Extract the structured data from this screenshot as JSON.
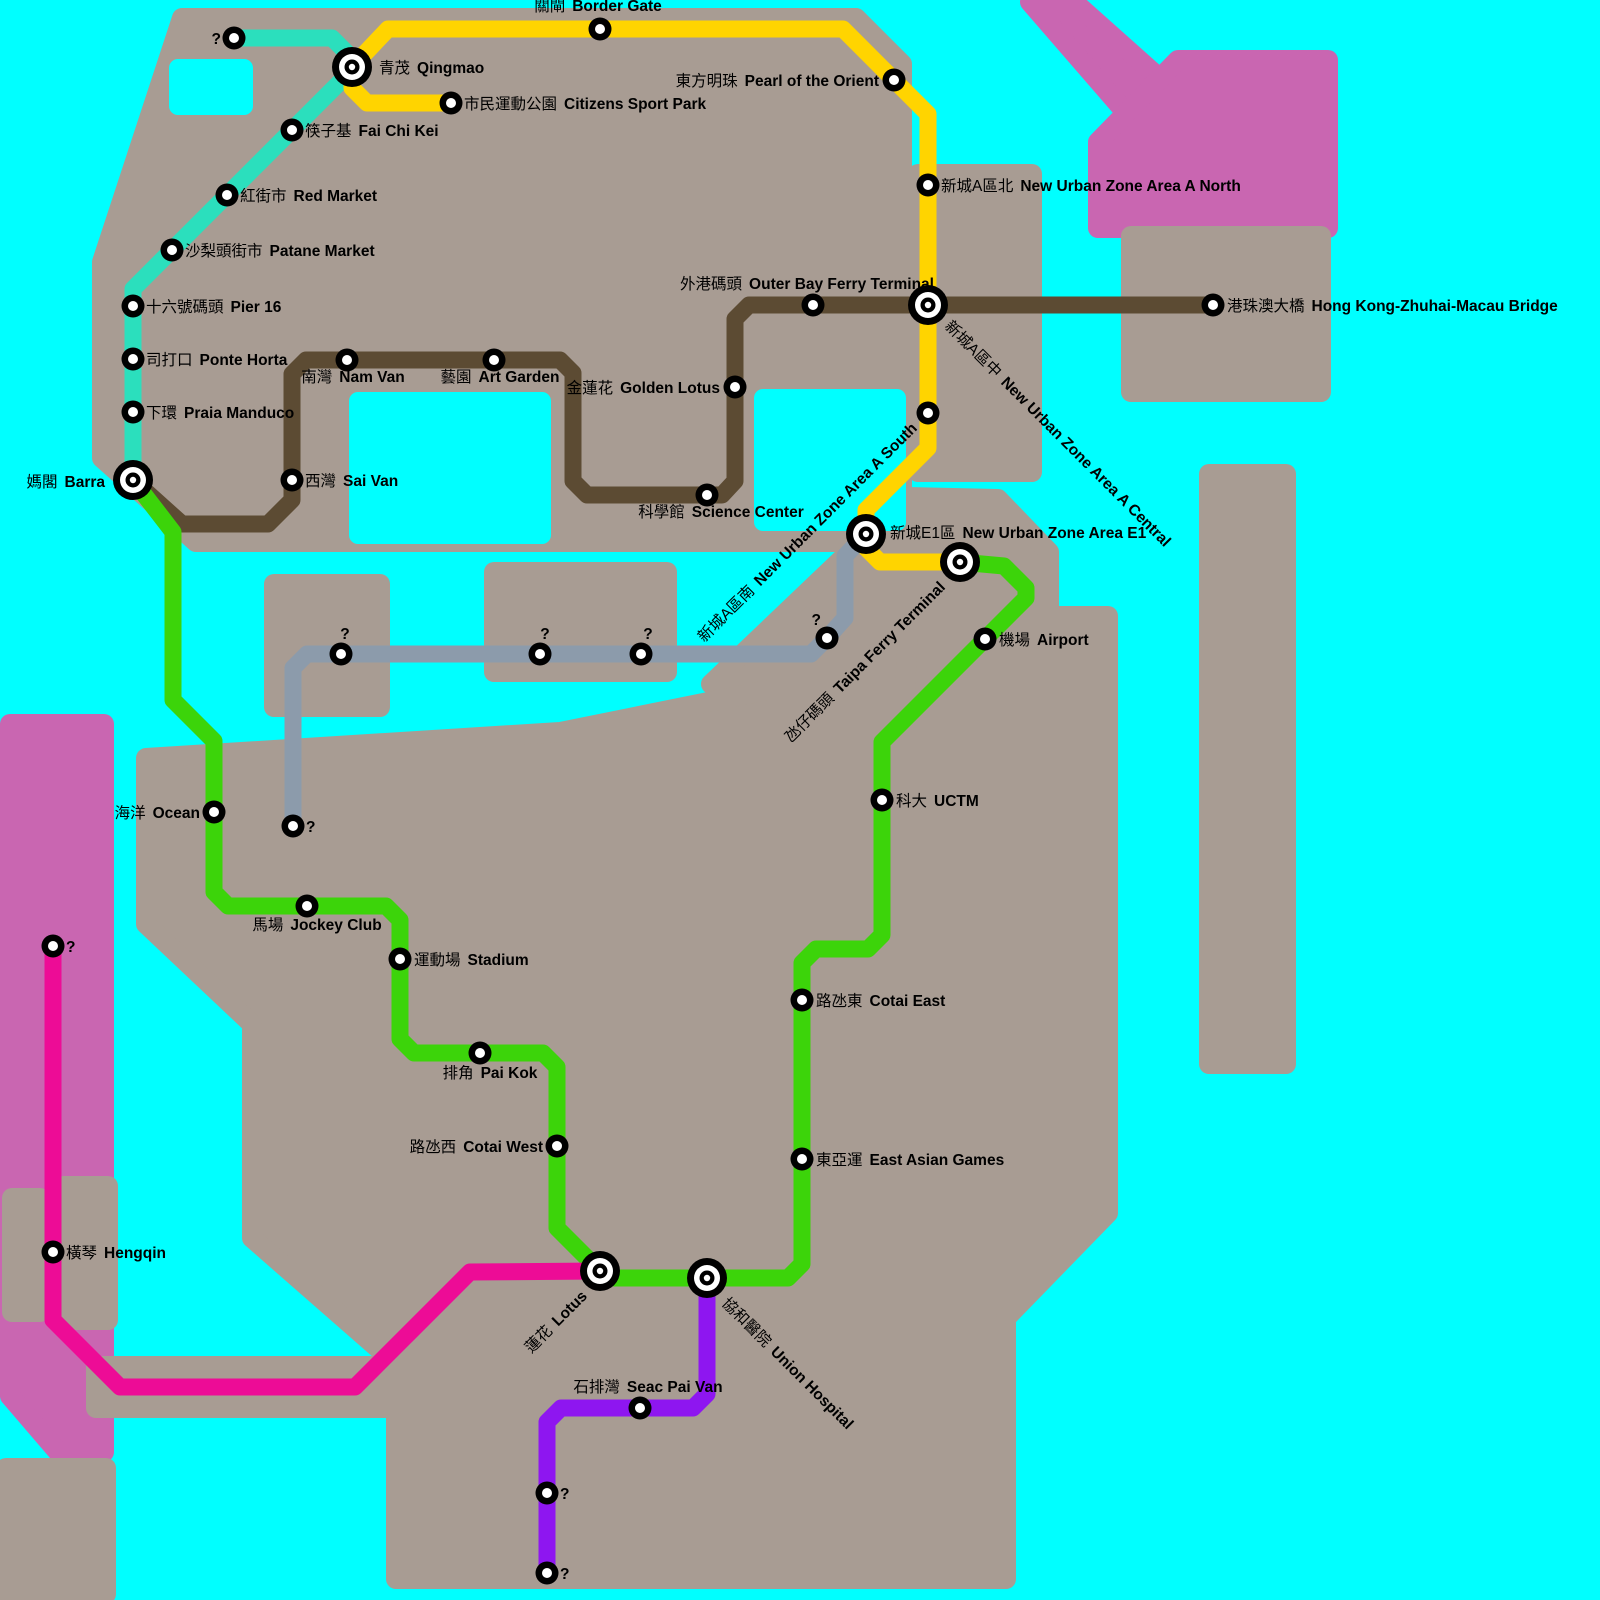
{
  "map": {
    "colors": {
      "water": "#00FFFF",
      "land": "#A89C93",
      "mainland_pink": "#C966B1",
      "station_ring": "#000000",
      "station_center": "#FFFFFF",
      "label_text": "#000000"
    },
    "lines": [
      {
        "id": "teal",
        "color": "#2BDFBD",
        "width": 17,
        "points": [
          [
            234,
            38
          ],
          [
            332,
            38
          ],
          [
            352,
            58
          ],
          [
            352,
            70
          ],
          [
            133,
            289
          ],
          [
            133,
            480
          ]
        ]
      },
      {
        "id": "yellow",
        "color": "#FFD400",
        "width": 17,
        "points": [
          [
            352,
            67
          ],
          [
            388,
            29
          ],
          [
            843,
            29
          ],
          [
            928,
            114
          ],
          [
            928,
            448
          ],
          [
            866,
            510
          ],
          [
            866,
            548
          ],
          [
            880,
            562
          ],
          [
            960,
            562
          ]
        ]
      },
      {
        "id": "yellow-branch",
        "color": "#FFD400",
        "width": 17,
        "points": [
          [
            352,
            67
          ],
          [
            352,
            88
          ],
          [
            367,
            103
          ],
          [
            451,
            103
          ]
        ]
      },
      {
        "id": "brown",
        "color": "#5C4B33",
        "width": 17,
        "points": [
          [
            133,
            480
          ],
          [
            182,
            524
          ],
          [
            268,
            524
          ],
          [
            292,
            500
          ],
          [
            292,
            374
          ],
          [
            306,
            360
          ],
          [
            560,
            360
          ],
          [
            573,
            373
          ],
          [
            573,
            481
          ],
          [
            587,
            495
          ],
          [
            722,
            495
          ],
          [
            735,
            481
          ],
          [
            735,
            319
          ],
          [
            749,
            305
          ],
          [
            1213,
            305
          ]
        ]
      },
      {
        "id": "green",
        "color": "#3CD40A",
        "width": 17,
        "points": [
          [
            133,
            480
          ],
          [
            173,
            532
          ],
          [
            173,
            700
          ],
          [
            214,
            741
          ],
          [
            214,
            892
          ],
          [
            228,
            906
          ],
          [
            386,
            906
          ],
          [
            400,
            920
          ],
          [
            400,
            1039
          ],
          [
            414,
            1053
          ],
          [
            543,
            1053
          ],
          [
            557,
            1067
          ],
          [
            557,
            1228
          ],
          [
            600,
            1271
          ],
          [
            614,
            1278
          ],
          [
            788,
            1278
          ],
          [
            802,
            1264
          ],
          [
            802,
            963
          ],
          [
            816,
            949
          ],
          [
            868,
            949
          ],
          [
            882,
            935
          ],
          [
            882,
            742
          ],
          [
            1026,
            598
          ],
          [
            1026,
            588
          ],
          [
            1004,
            566
          ],
          [
            960,
            562
          ]
        ]
      },
      {
        "id": "gray",
        "color": "#8C9BAB",
        "width": 17,
        "points": [
          [
            866,
            534
          ],
          [
            845,
            556
          ],
          [
            845,
            618
          ],
          [
            827,
            638
          ],
          [
            811,
            654
          ],
          [
            307,
            654
          ],
          [
            293,
            668
          ],
          [
            293,
            826
          ]
        ]
      },
      {
        "id": "pink",
        "color": "#ED0C96",
        "width": 17,
        "points": [
          [
            53,
            946
          ],
          [
            53,
            1320
          ],
          [
            120,
            1387
          ],
          [
            355,
            1387
          ],
          [
            470,
            1272
          ],
          [
            600,
            1271
          ]
        ]
      },
      {
        "id": "purple",
        "color": "#8E16F0",
        "width": 17,
        "points": [
          [
            707,
            1278
          ],
          [
            707,
            1394
          ],
          [
            693,
            1408
          ],
          [
            561,
            1408
          ],
          [
            547,
            1422
          ],
          [
            547,
            1573
          ]
        ]
      }
    ],
    "stations": [
      {
        "id": "unknown-northwest",
        "zh": "",
        "en": "?",
        "line": "teal",
        "x": 234,
        "y": 38,
        "kind": "normal",
        "label": {
          "dx": -13,
          "dy": 6,
          "anchor": "end"
        }
      },
      {
        "id": "qingmao",
        "zh": "青茂",
        "en": "Qingmao",
        "line": "teal",
        "x": 352,
        "y": 67,
        "kind": "interchange",
        "label": {
          "dx": 27,
          "dy": 6
        }
      },
      {
        "id": "fai-chi-kei",
        "zh": "筷子基",
        "en": "Fai Chi Kei",
        "line": "teal",
        "x": 292,
        "y": 130,
        "kind": "normal",
        "label": {
          "dx": 13,
          "dy": 6
        }
      },
      {
        "id": "red-market",
        "zh": "紅街市",
        "en": "Red Market",
        "line": "teal",
        "x": 227,
        "y": 195,
        "kind": "normal",
        "label": {
          "dx": 13,
          "dy": 6
        }
      },
      {
        "id": "patane-market",
        "zh": "沙梨頭街市",
        "en": "Patane Market",
        "line": "teal",
        "x": 172,
        "y": 250,
        "kind": "normal",
        "label": {
          "dx": 13,
          "dy": 6
        }
      },
      {
        "id": "pier-16",
        "zh": "十六號碼頭",
        "en": "Pier 16",
        "line": "teal",
        "x": 133,
        "y": 306,
        "kind": "normal",
        "label": {
          "dx": 13,
          "dy": 6
        }
      },
      {
        "id": "ponte-horta",
        "zh": "司打口",
        "en": "Ponte Horta",
        "line": "teal",
        "x": 133,
        "y": 359,
        "kind": "normal",
        "label": {
          "dx": 13,
          "dy": 6
        }
      },
      {
        "id": "praia-manduco",
        "zh": "下環",
        "en": "Praia Manduco",
        "line": "teal",
        "x": 133,
        "y": 412,
        "kind": "normal",
        "label": {
          "dx": 13,
          "dy": 6
        }
      },
      {
        "id": "barra",
        "zh": "媽閣",
        "en": "Barra",
        "line": "teal green brown",
        "x": 133,
        "y": 480,
        "kind": "interchange",
        "label": {
          "dx": -28,
          "dy": 7,
          "anchor": "end"
        }
      },
      {
        "id": "border-gate",
        "zh": "關閘",
        "en": "Border Gate",
        "line": "yellow",
        "x": 600,
        "y": 29,
        "kind": "normal",
        "label": {
          "dx": -2,
          "dy": -18,
          "anchor": "middle"
        }
      },
      {
        "id": "citizens-sport-park",
        "zh": "市民運動公園",
        "en": "Citizens Sport Park",
        "line": "yellow",
        "x": 451,
        "y": 103,
        "kind": "normal",
        "label": {
          "dx": 13,
          "dy": 6
        }
      },
      {
        "id": "pearl-of-the-orient",
        "zh": "東方明珠",
        "en": "Pearl of the Orient",
        "line": "yellow",
        "x": 894,
        "y": 80,
        "kind": "normal",
        "label": {
          "dx": -15,
          "dy": 6,
          "anchor": "end"
        }
      },
      {
        "id": "new-urban-zone-area-a-north",
        "zh": "新城A區北",
        "en": "New Urban Zone Area A North",
        "line": "yellow",
        "x": 928,
        "y": 185,
        "kind": "normal",
        "label": {
          "dx": 13,
          "dy": 6
        }
      },
      {
        "id": "new-urban-zone-area-a-central",
        "zh": "新城A區中",
        "en": "New Urban Zone Area A Central",
        "line": "yellow brown",
        "x": 928,
        "y": 305,
        "kind": "interchange",
        "label": {
          "dx": 16,
          "dy": 22,
          "rotate": 45
        }
      },
      {
        "id": "new-urban-zone-area-a-south",
        "zh": "新城A區南",
        "en": "New Urban Zone Area A South",
        "line": "yellow",
        "x": 928,
        "y": 413,
        "kind": "normal",
        "label": {
          "dx": -10,
          "dy": 16,
          "anchor": "end",
          "rotate": -45
        }
      },
      {
        "id": "new-urban-zone-area-e1",
        "zh": "新城E1區",
        "en": "New Urban Zone Area E1",
        "line": "yellow gray",
        "x": 866,
        "y": 534,
        "kind": "interchange",
        "label": {
          "dx": 24,
          "dy": 4
        }
      },
      {
        "id": "taipa-ferry-terminal",
        "zh": "氹仔碼頭",
        "en": "Taipa Ferry Terminal",
        "line": "yellow green",
        "x": 960,
        "y": 562,
        "kind": "interchange",
        "label": {
          "dx": -14,
          "dy": 26,
          "anchor": "end",
          "rotate": -45
        }
      },
      {
        "id": "unknown-bend",
        "zh": "",
        "en": "?",
        "line": "gray",
        "x": 827,
        "y": 638,
        "kind": "normal",
        "label": {
          "dx": -6,
          "dy": -13,
          "anchor": "end"
        }
      },
      {
        "id": "unknown-taipa-east",
        "zh": "",
        "en": "?",
        "line": "gray",
        "x": 641,
        "y": 654,
        "kind": "normal",
        "label": {
          "dx": 7,
          "dy": -15,
          "anchor": "middle"
        }
      },
      {
        "id": "unknown-taipa-mid",
        "zh": "",
        "en": "?",
        "line": "gray",
        "x": 540,
        "y": 654,
        "kind": "normal",
        "label": {
          "dx": 5,
          "dy": -15,
          "anchor": "middle"
        }
      },
      {
        "id": "unknown-taipa-west",
        "zh": "",
        "en": "?",
        "line": "gray",
        "x": 341,
        "y": 654,
        "kind": "normal",
        "label": {
          "dx": 4,
          "dy": -15,
          "anchor": "middle"
        }
      },
      {
        "id": "unknown-south-terminus",
        "zh": "",
        "en": "?",
        "line": "gray",
        "x": 293,
        "y": 826,
        "kind": "normal",
        "label": {
          "dx": 13,
          "dy": 6
        }
      },
      {
        "id": "ocean",
        "zh": "海洋",
        "en": "Ocean",
        "line": "green",
        "x": 214,
        "y": 812,
        "kind": "normal",
        "label": {
          "dx": -14,
          "dy": 6,
          "anchor": "end"
        }
      },
      {
        "id": "jockey-club",
        "zh": "馬場",
        "en": "Jockey Club",
        "line": "green",
        "x": 307,
        "y": 906,
        "kind": "normal",
        "label": {
          "dx": 10,
          "dy": 24,
          "anchor": "middle"
        }
      },
      {
        "id": "stadium",
        "zh": "運動場",
        "en": "Stadium",
        "line": "green",
        "x": 400,
        "y": 959,
        "kind": "normal",
        "label": {
          "dx": 14,
          "dy": 6
        }
      },
      {
        "id": "pai-kok",
        "zh": "排角",
        "en": "Pai Kok",
        "line": "green",
        "x": 480,
        "y": 1053,
        "kind": "normal",
        "label": {
          "dx": 10,
          "dy": 25,
          "anchor": "middle"
        }
      },
      {
        "id": "cotai-west",
        "zh": "路氹西",
        "en": "Cotai West",
        "line": "green",
        "x": 557,
        "y": 1146,
        "kind": "normal",
        "label": {
          "dx": -14,
          "dy": 6,
          "anchor": "end"
        }
      },
      {
        "id": "lotus",
        "zh": "蓮花",
        "en": "Lotus",
        "line": "green pink",
        "x": 600,
        "y": 1271,
        "kind": "interchange",
        "label": {
          "dx": -12,
          "dy": 26,
          "anchor": "end",
          "rotate": -45
        }
      },
      {
        "id": "union-hospital",
        "zh": "協和醫院",
        "en": "Union Hospital",
        "line": "green purple",
        "x": 707,
        "y": 1278,
        "kind": "interchange",
        "label": {
          "dx": 14,
          "dy": 26,
          "rotate": 45
        }
      },
      {
        "id": "east-asian-games",
        "zh": "東亞運",
        "en": "East Asian Games",
        "line": "green",
        "x": 802,
        "y": 1159,
        "kind": "normal",
        "label": {
          "dx": 14,
          "dy": 6
        }
      },
      {
        "id": "cotai-east",
        "zh": "路氹東",
        "en": "Cotai East",
        "line": "green",
        "x": 802,
        "y": 1000,
        "kind": "normal",
        "label": {
          "dx": 14,
          "dy": 6
        }
      },
      {
        "id": "uctm",
        "zh": "科大",
        "en": "UCTM",
        "line": "green",
        "x": 882,
        "y": 800,
        "kind": "normal",
        "label": {
          "dx": 14,
          "dy": 6
        }
      },
      {
        "id": "airport",
        "zh": "機場",
        "en": "Airport",
        "line": "green",
        "x": 985,
        "y": 639,
        "kind": "normal",
        "label": {
          "dx": 14,
          "dy": 6
        }
      },
      {
        "id": "sai-van",
        "zh": "西灣",
        "en": "Sai Van",
        "line": "brown",
        "x": 292,
        "y": 480,
        "kind": "normal",
        "label": {
          "dx": 13,
          "dy": 6
        }
      },
      {
        "id": "nam-van",
        "zh": "南灣",
        "en": "Nam Van",
        "line": "brown",
        "x": 347,
        "y": 360,
        "kind": "normal",
        "label": {
          "dx": 6,
          "dy": 22,
          "anchor": "middle"
        }
      },
      {
        "id": "art-garden",
        "zh": "藝園",
        "en": "Art Garden",
        "line": "brown",
        "x": 494,
        "y": 360,
        "kind": "normal",
        "label": {
          "dx": 6,
          "dy": 22,
          "anchor": "middle"
        }
      },
      {
        "id": "science-center",
        "zh": "科學館",
        "en": "Science Center",
        "line": "brown",
        "x": 707,
        "y": 495,
        "kind": "normal",
        "label": {
          "dx": 14,
          "dy": 22,
          "anchor": "middle"
        }
      },
      {
        "id": "golden-lotus",
        "zh": "金蓮花",
        "en": "Golden Lotus",
        "line": "brown",
        "x": 735,
        "y": 387,
        "kind": "normal",
        "label": {
          "dx": -15,
          "dy": 6,
          "anchor": "end"
        }
      },
      {
        "id": "outer-bay-ferry-terminal",
        "zh": "外港碼頭",
        "en": "Outer Bay Ferry Terminal",
        "line": "brown",
        "x": 813,
        "y": 305,
        "kind": "normal",
        "label": {
          "dx": -6,
          "dy": -16,
          "anchor": "middle"
        }
      },
      {
        "id": "hong-kong-zhuhai-macau-bridge",
        "zh": "港珠澳大橋",
        "en": "Hong Kong-Zhuhai-Macau Bridge",
        "line": "brown",
        "x": 1213,
        "y": 305,
        "kind": "normal",
        "label": {
          "dx": 14,
          "dy": 6
        }
      },
      {
        "id": "unknown-hengqin-north",
        "zh": "",
        "en": "?",
        "line": "pink",
        "x": 53,
        "y": 946,
        "kind": "normal",
        "label": {
          "dx": 13,
          "dy": 6
        }
      },
      {
        "id": "hengqin",
        "zh": "橫琴",
        "en": "Hengqin",
        "line": "pink",
        "x": 53,
        "y": 1252,
        "kind": "normal",
        "label": {
          "dx": 13,
          "dy": 6
        }
      },
      {
        "id": "seac-pai-van",
        "zh": "石排灣",
        "en": "Seac Pai Van",
        "line": "purple",
        "x": 640,
        "y": 1408,
        "kind": "normal",
        "label": {
          "dx": 8,
          "dy": -16,
          "anchor": "middle"
        }
      },
      {
        "id": "unknown-coloane-mid",
        "zh": "",
        "en": "?",
        "line": "purple",
        "x": 547,
        "y": 1493,
        "kind": "normal",
        "label": {
          "dx": 13,
          "dy": 6
        }
      },
      {
        "id": "unknown-coloane-south",
        "zh": "",
        "en": "?",
        "line": "purple",
        "x": 547,
        "y": 1573,
        "kind": "normal",
        "label": {
          "dx": 13,
          "dy": 6
        }
      }
    ]
  }
}
